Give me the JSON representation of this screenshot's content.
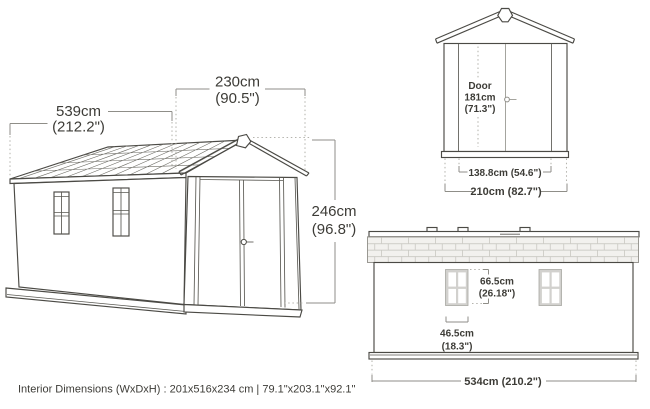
{
  "diagram_title": "Shed dimension diagram",
  "perspective_view": {
    "depth_cm": "539cm",
    "depth_in": "(212.2\")",
    "width_cm": "230cm",
    "width_in": "(90.5\")",
    "height_cm": "246cm",
    "height_in": "(96.8\")"
  },
  "front_view": {
    "door_word": "Door",
    "door_height_cm": "181cm",
    "door_height_in": "(71.3\")",
    "door_width": "138.8cm (54.6\")",
    "overall_width": "210cm (82.7\")"
  },
  "side_view": {
    "window_height_cm": "66.5cm",
    "window_height_in": "(26.18\")",
    "window_width_cm": "46.5cm",
    "window_width_in": "(18.3\")",
    "overall_length": "534cm (210.2\")"
  },
  "footer": {
    "interior_dimensions": "Interior Dimensions (WxDxH) : 201x516x234 cm | 79.1\"x203.1\"x92.1\""
  },
  "colors": {
    "line_dark": "#4b4a45",
    "dimension_gray": "#8f8e88",
    "dotted_gray": "#b5b4ae",
    "text": "#3d3c37",
    "brick_fill": "#f2f1ee",
    "window_frame": "#d2d1ce",
    "background": "#ffffff"
  }
}
